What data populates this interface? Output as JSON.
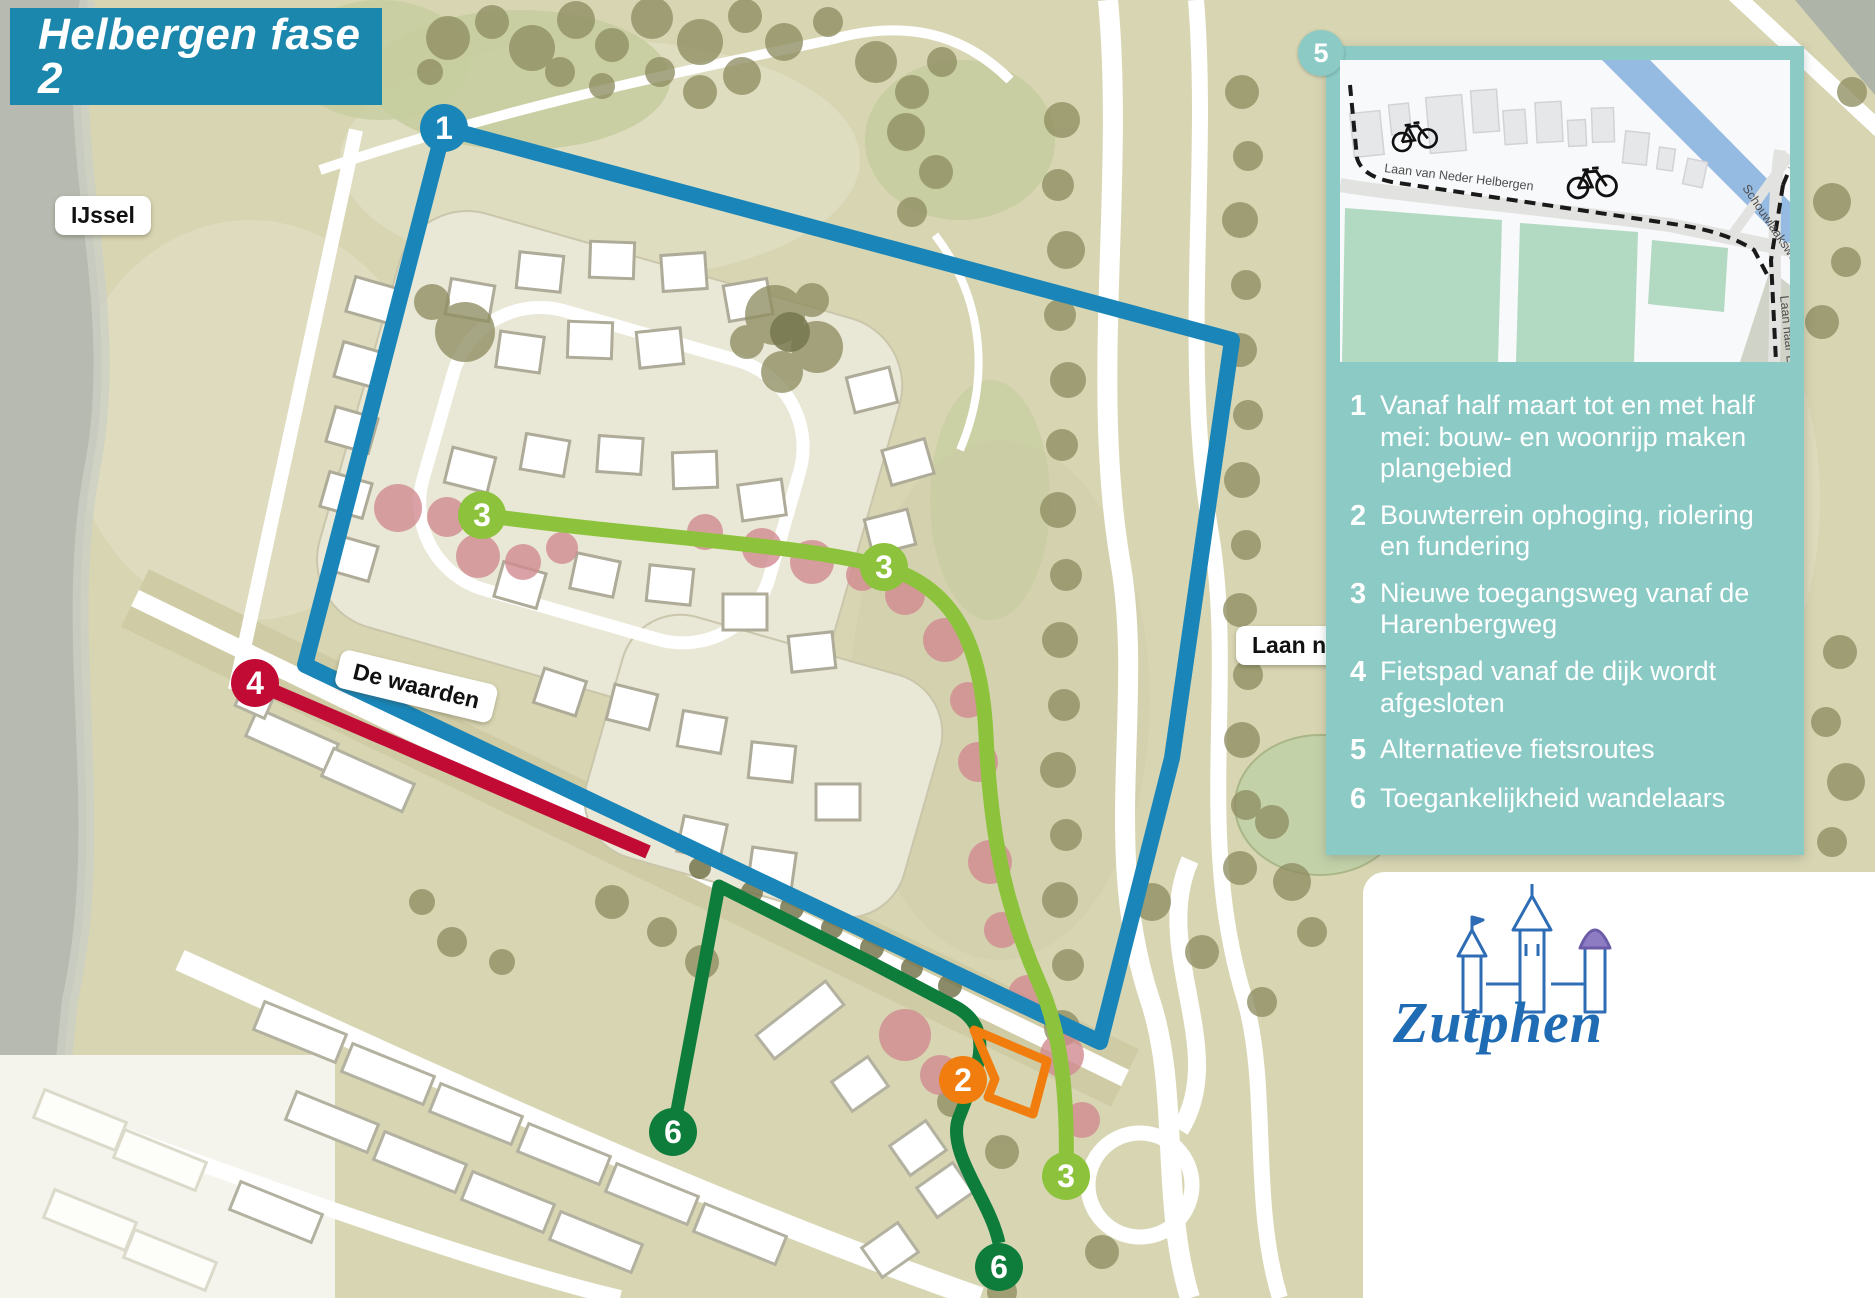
{
  "title": "Helbergen fase 2",
  "map_labels": {
    "ijssel": "IJssel",
    "de_waarden": "De waarden",
    "laan_naar": "Laan naar"
  },
  "legend": {
    "items": [
      {
        "num": "1",
        "text": "Vanaf half maart tot en met half mei: bouw- en woonrijp maken plangebied"
      },
      {
        "num": "2",
        "text": "Bouwterrein ophoging, riolering en fundering"
      },
      {
        "num": "3",
        "text": "Nieuwe toegangsweg vanaf de Harenbergweg"
      },
      {
        "num": "4",
        "text": "Fietspad vanaf de dijk wordt afgesloten"
      },
      {
        "num": "5",
        "text": "Alternatieve fietsroutes"
      },
      {
        "num": "6",
        "text": "Toegankelijkheid wandelaars"
      }
    ]
  },
  "markers": {
    "m1": "1",
    "m2": "2",
    "m3": "3",
    "m4": "4",
    "m6": "6"
  },
  "inset": {
    "number": "5",
    "streets": {
      "a": "Laan van Neder Helbergen",
      "b": "Schouwlaaksweg",
      "c": "Laan naar Erne"
    }
  },
  "logo": {
    "text": "Zutphen"
  },
  "colors": {
    "title_bg": "#1b87ac",
    "legend_bg": "#8ccac5",
    "route_blue": "#1985b8",
    "route_orange": "#f07d0d",
    "route_lime": "#8dc33c",
    "route_red": "#c10b35",
    "route_green": "#0e7d3c",
    "inset_canal": "#96bbe2",
    "inset_field": "#b2d9c2",
    "logo_blue": "#1f6cb5"
  }
}
